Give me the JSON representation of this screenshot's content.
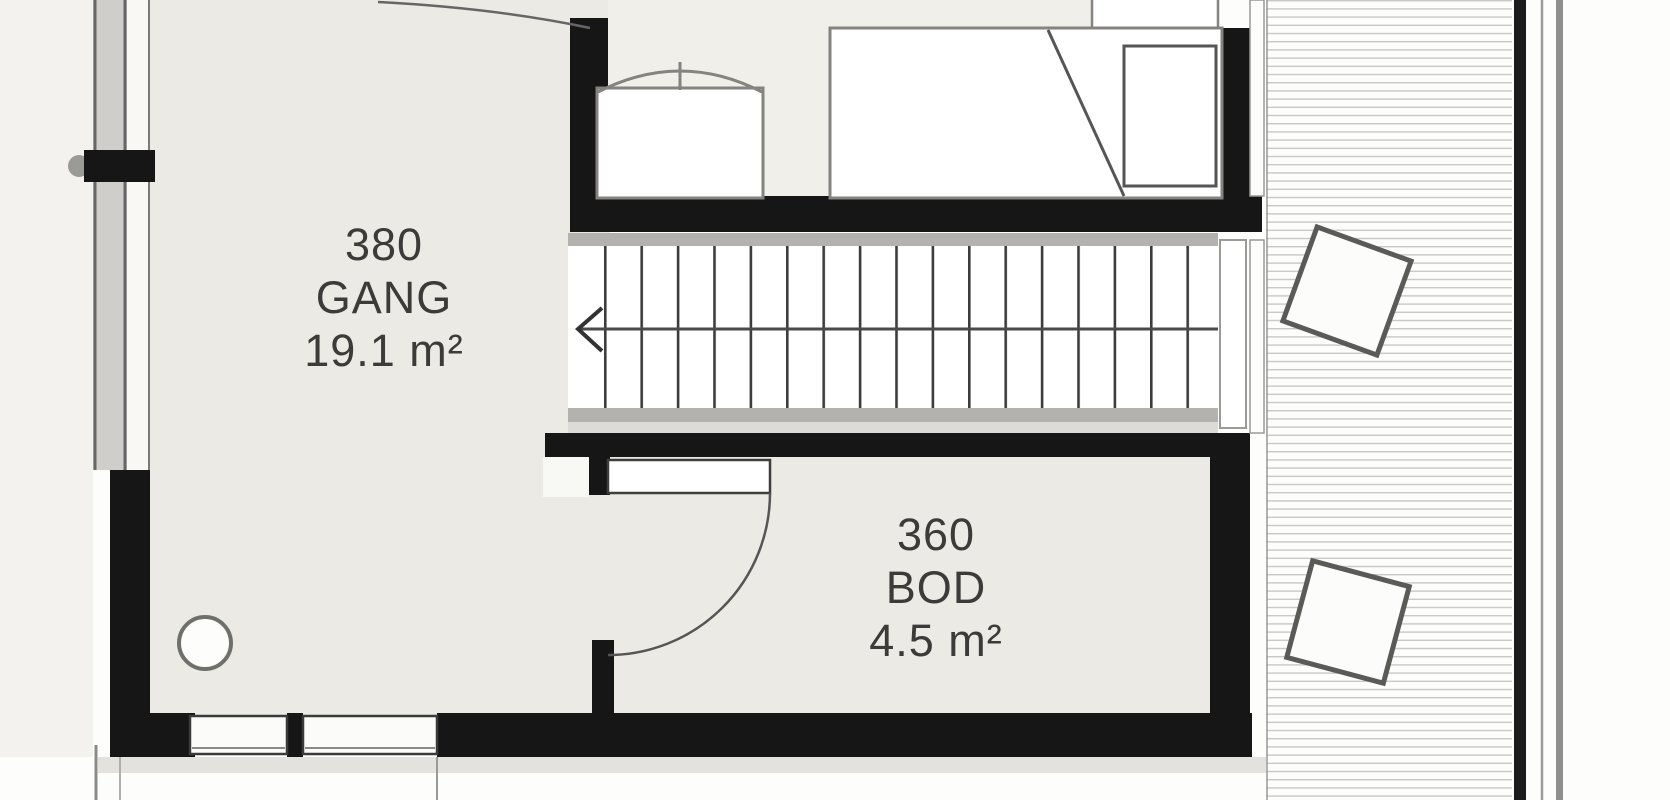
{
  "plan_title": "floor-plan",
  "rooms": [
    {
      "number": "380",
      "name": "GANG",
      "area": "19.1 m²"
    },
    {
      "number": "360",
      "name": "BOD",
      "area": "4.5 m²"
    }
  ],
  "stairs": {
    "direction_arrow": "left"
  },
  "colors": {
    "wall": "#161616",
    "room_fill": "#ebeae4",
    "bedroom_floor": "#f0efe9",
    "stringer_gray": "#b3b2ae",
    "hatch_line": "#c9c8c3",
    "furniture_outline": "#84837f",
    "label_text": "#3c3b39"
  }
}
